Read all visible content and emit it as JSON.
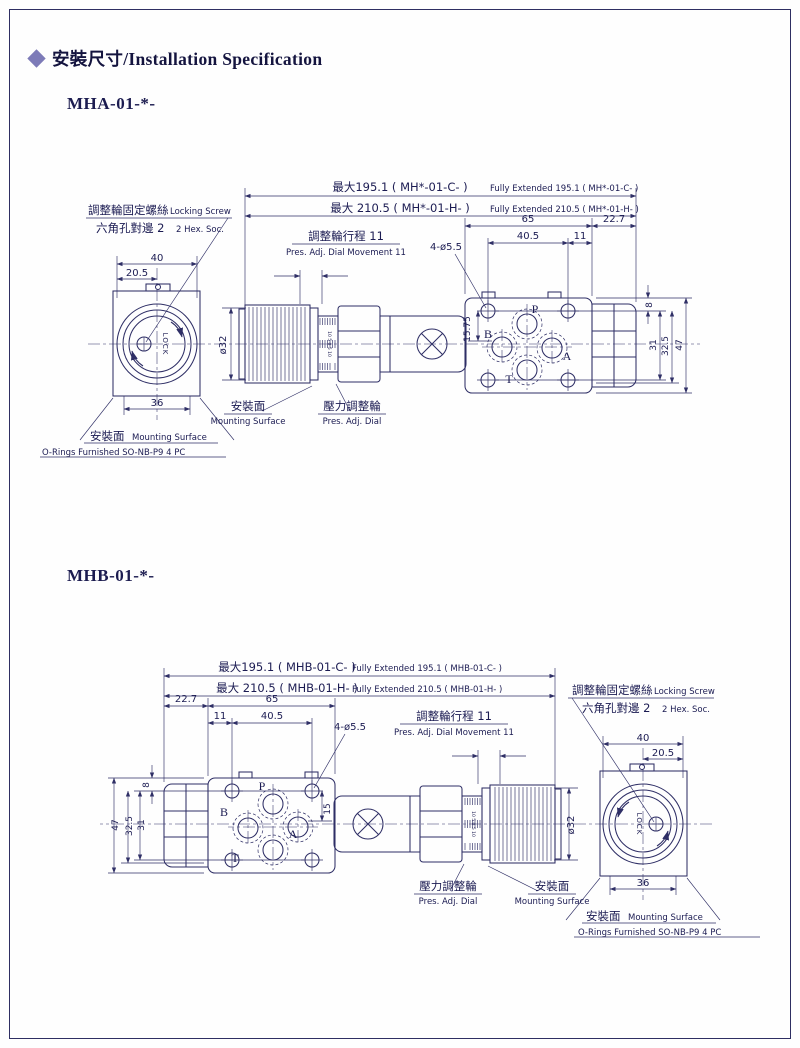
{
  "page": {
    "header": {
      "title": "安裝尺寸/Installation Specification",
      "accent_color": "#7d7bb8",
      "line_color": "#2f2f66"
    }
  },
  "figs": [
    {
      "heading": "MHA-01-*-",
      "overall": {
        "c_zh": "最大195.1 ( MH*-01-C- )",
        "c_en": "Fully Extended 195.1 ( MH*-01-C- )",
        "h_zh": "最大 210.5 ( MH*-01-H- )",
        "h_en": "Fully Extended 210.5 ( MH*-01-H- )"
      },
      "locking_screw": {
        "zh": "調整輪固定螺絲",
        "en": "Locking Screw"
      },
      "hex_socket": {
        "zh": "六角孔對邊 2",
        "en": "2 Hex. Soc."
      },
      "dial_travel": {
        "zh": "調整輪行程 11",
        "en": "Pres. Adj. Dial Movement 11"
      },
      "pres_dial": {
        "zh": "壓力調整輪",
        "en": "Pres. Adj. Dial"
      },
      "mounting_mid": {
        "zh": "安裝面",
        "en": "Mounting Surface"
      },
      "mounting_end": {
        "zh": "安裝面",
        "en": "Mounting Surface"
      },
      "orings": "O-Rings Furnished SO-NB-P9 4 PC",
      "dims": {
        "d40": "40",
        "d205": "20.5",
        "d36": "36",
        "d65": "65",
        "d227": "22.7",
        "d405": "40.5",
        "d11": "11",
        "d8": "8",
        "d31": "31",
        "d325": "32.5",
        "d47": "47",
        "d15": "15.75",
        "dia32": "ø32",
        "holes": "4-ø5.5"
      },
      "ports": {
        "p": "P",
        "b": "B",
        "a": "A",
        "t": "T"
      },
      "lock_text": "LOCK",
      "scale_marks": "10 5 0 5 10"
    },
    {
      "heading": "MHB-01-*-",
      "overall": {
        "c_zh": "最大195.1 ( MHB-01-C- )",
        "c_en": "Fully Extended 195.1 ( MHB-01-C- )",
        "h_zh": "最大 210.5 ( MHB-01-H- )",
        "h_en": "Fully Extended 210.5 ( MHB-01-H- )"
      },
      "locking_screw": {
        "zh": "調整輪固定螺絲",
        "en": "Locking Screw"
      },
      "hex_socket": {
        "zh": "六角孔對邊 2",
        "en": "2 Hex. Soc."
      },
      "dial_travel": {
        "zh": "調整輪行程 11",
        "en": "Pres. Adj. Dial Movement 11"
      },
      "pres_dial": {
        "zh": "壓力調整輪",
        "en": "Pres. Adj. Dial"
      },
      "mounting_mid": {
        "zh": "安裝面",
        "en": "Mounting Surface"
      },
      "mounting_end": {
        "zh": "安裝面",
        "en": "Mounting Surface"
      },
      "orings": "O-Rings Furnished SO-NB-P9 4 PC",
      "dims": {
        "d40": "40",
        "d205": "20.5",
        "d36": "36",
        "d65": "65",
        "d227": "22.7",
        "d405": "40.5",
        "d11": "11",
        "d8": "8",
        "d31": "31",
        "d325": "32.5",
        "d47": "47",
        "d15": "15",
        "dia32": "ø32",
        "holes": "4-ø5.5"
      },
      "ports": {
        "p": "P",
        "b": "B",
        "a": "A",
        "t": "T"
      },
      "lock_text": "LOCK",
      "scale_marks": "10 5 0 5 10"
    }
  ]
}
